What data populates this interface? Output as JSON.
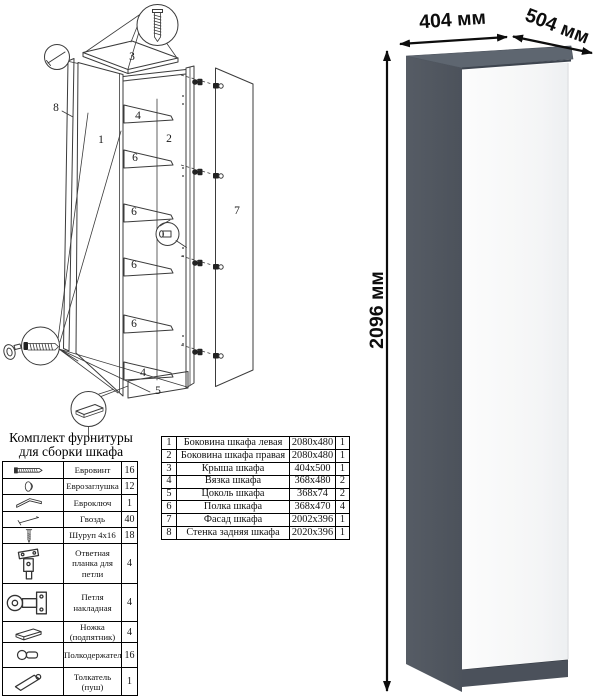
{
  "diagram": {
    "labels": {
      "side_left": "1",
      "side_right": "2",
      "top": "3",
      "brace": "4",
      "plinth": "5",
      "shelf": "6",
      "facade": "7",
      "back": "8"
    }
  },
  "hardware_kit": {
    "title_line1": "Комплект фурнитуры",
    "title_line2": "для сборки шкафа",
    "rows": [
      {
        "icon": "euro-screw-icon",
        "name": "Евровинт",
        "qty": "16"
      },
      {
        "icon": "euro-plug-icon",
        "name": "Еврозаглушка",
        "qty": "12"
      },
      {
        "icon": "euro-key-icon",
        "name": "Евроключ",
        "qty": "1"
      },
      {
        "icon": "nail-icon",
        "name": "Гвоздь",
        "qty": "40"
      },
      {
        "icon": "screw-icon",
        "name": "Шуруп 4x16",
        "qty": "18"
      },
      {
        "icon": "strike-plate-icon",
        "name": "Ответная планка для петли",
        "qty": "4"
      },
      {
        "icon": "hinge-icon",
        "name": "Петля накладная",
        "qty": "4"
      },
      {
        "icon": "foot-icon",
        "name": "Ножка (подпятник)",
        "qty": "4"
      },
      {
        "icon": "shelf-support-icon",
        "name": "Полкодержатель",
        "qty": "16"
      },
      {
        "icon": "push-opener-icon",
        "name": "Толкатель (пуш)",
        "qty": "1"
      }
    ]
  },
  "parts_table": {
    "rows": [
      {
        "num": "1",
        "name": "Боковина шкафа левая",
        "size": "2080x480",
        "qty": "1"
      },
      {
        "num": "2",
        "name": "Боковина шкафа правая",
        "size": "2080x480",
        "qty": "1"
      },
      {
        "num": "3",
        "name": "Крыша шкафа",
        "size": "404x500",
        "qty": "1"
      },
      {
        "num": "4",
        "name": "Вязка шкафа",
        "size": "368x480",
        "qty": "2"
      },
      {
        "num": "5",
        "name": "Цоколь шкафа",
        "size": "368x74",
        "qty": "2"
      },
      {
        "num": "6",
        "name": "Полка шкафа",
        "size": "368x470",
        "qty": "4"
      },
      {
        "num": "7",
        "name": "Фасад шкафа",
        "size": "2002x396",
        "qty": "1"
      },
      {
        "num": "8",
        "name": "Стенка задняя шкафа",
        "size": "2020x396",
        "qty": "1"
      }
    ]
  },
  "render": {
    "dim_width": "404 мм",
    "dim_depth": "504 мм",
    "dim_height": "2096 мм",
    "colors": {
      "top": "#5e6670",
      "side": "#51575f",
      "plinth": "#4b515b",
      "door": "#fafafa"
    }
  }
}
